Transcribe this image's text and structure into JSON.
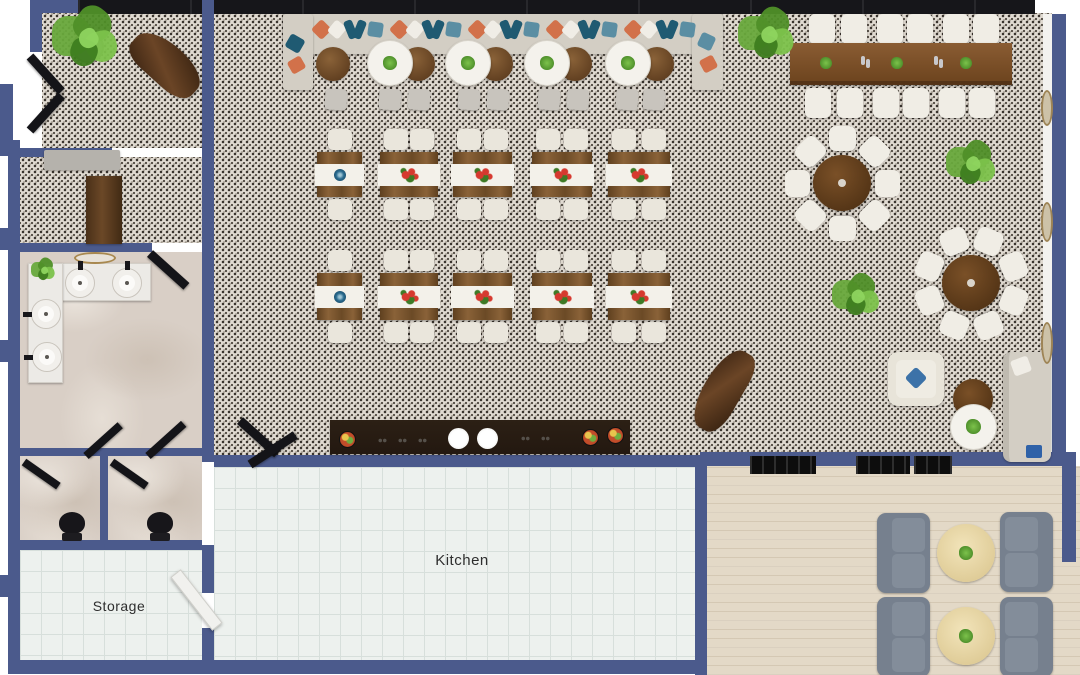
{
  "title": "Restaurant floor plan - top-down 3D render",
  "rooms": {
    "kitchen": {
      "label": "Kitchen"
    },
    "storage": {
      "label": "Storage"
    }
  },
  "colors": {
    "wall": "#4b5a8c",
    "storefront": "#16161a",
    "banquette": "#d3cec4",
    "banquette_back": "#bfbab0",
    "pillow_orange": "#d2714a",
    "pillow_teal": "#1f5a72",
    "pillow_blue": "#5b8ea3",
    "pillow_white": "#f0ede6",
    "wood_medium": "#7a5530",
    "wood_dark": "#5e3d1f",
    "counter_dark": "#231810",
    "chair_cream": "#eae6dc",
    "chair_white": "#f0ede5",
    "stool_gray": "#c8c4bd",
    "sofa_gray": "#76808e",
    "sofa_cushion": "#838d9a",
    "patio_table": "#e8d8a8",
    "plant_green": "#5f9e33",
    "pot_gray": "#928b81",
    "accent_blue": "#3c72a8",
    "door_black": "#141418",
    "door_white": "#f1f1ee",
    "gold": "#a8884f",
    "runner_white": "#f3f1ea",
    "flower_red": "#d6392f",
    "bowl_blue": "#2a6b8f"
  },
  "inventory": {
    "dining_tables": 10,
    "banquette_round_tables": 9,
    "communal_table_seats": 12,
    "round_tables_eight_seats": 2,
    "patio_loveseats": 4,
    "patio_coffee_tables": 2,
    "restroom_sinks": 4,
    "toilet_stalls": 2
  }
}
